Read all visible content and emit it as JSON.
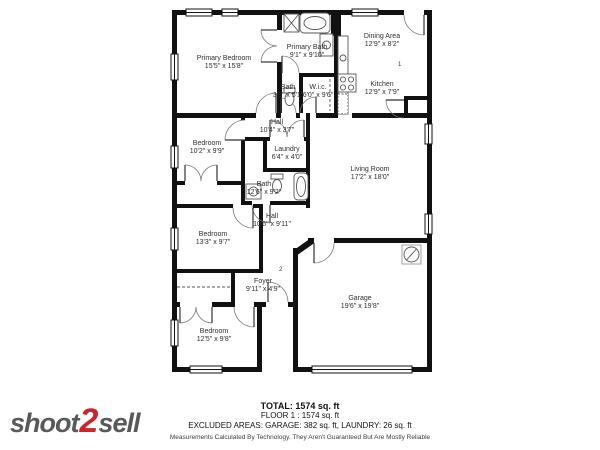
{
  "brand": {
    "logo_part1": "shoot",
    "logo_part2": "2",
    "logo_part3": "sell",
    "logo_gray": "#58595B",
    "logo_red": "#C9252C",
    "wall_color": "#111111"
  },
  "rooms": [
    {
      "name": "Primary Bedroom",
      "dims": "15'5\" x 15'8\""
    },
    {
      "name": "Primary Bath",
      "dims": "9'1\" x 9'10\""
    },
    {
      "name": "Dining Area",
      "dims": "12'9\" x 8'2\""
    },
    {
      "name": "Kitchen",
      "dims": "12'9\" x 7'9\""
    },
    {
      "name": "Bath",
      "dims": "3'9\" x 5'1\""
    },
    {
      "name": "W.i.c.",
      "dims": "6'0\" x 9'6\""
    },
    {
      "name": "Hall",
      "dims": "10'4\" x 3'7\""
    },
    {
      "name": "Bedroom",
      "dims": "10'2\" x 9'9\""
    },
    {
      "name": "Laundry",
      "dims": "6'4\" x 4'0\""
    },
    {
      "name": "Bath",
      "dims": "12'6\" x 9'2\""
    },
    {
      "name": "Living Room",
      "dims": "17'2\" x 18'0\""
    },
    {
      "name": "Hall",
      "dims": "10'6\" x 9'11\""
    },
    {
      "name": "Bedroom",
      "dims": "13'3\" x 9'7\""
    },
    {
      "name": "Foyer",
      "dims": "9'11\" x 4'9\""
    },
    {
      "name": "Bedroom",
      "dims": "12'5\" x 9'8\""
    },
    {
      "name": "Garage",
      "dims": "19'6\" x 19'8\""
    }
  ],
  "markers": {
    "one": "1",
    "two": "2"
  },
  "summary": {
    "total": "TOTAL: 1574 sq. ft",
    "floor": "FLOOR 1 : 1574 sq. ft",
    "excluded": "EXCLUDED AREAS: GARAGE: 382 sq. ft, LAUNDRY: 26 sq. ft",
    "disclaimer": "Measurements Calculated By Technology. They Aren't Guaranteed But Are Mostly Reliable"
  }
}
